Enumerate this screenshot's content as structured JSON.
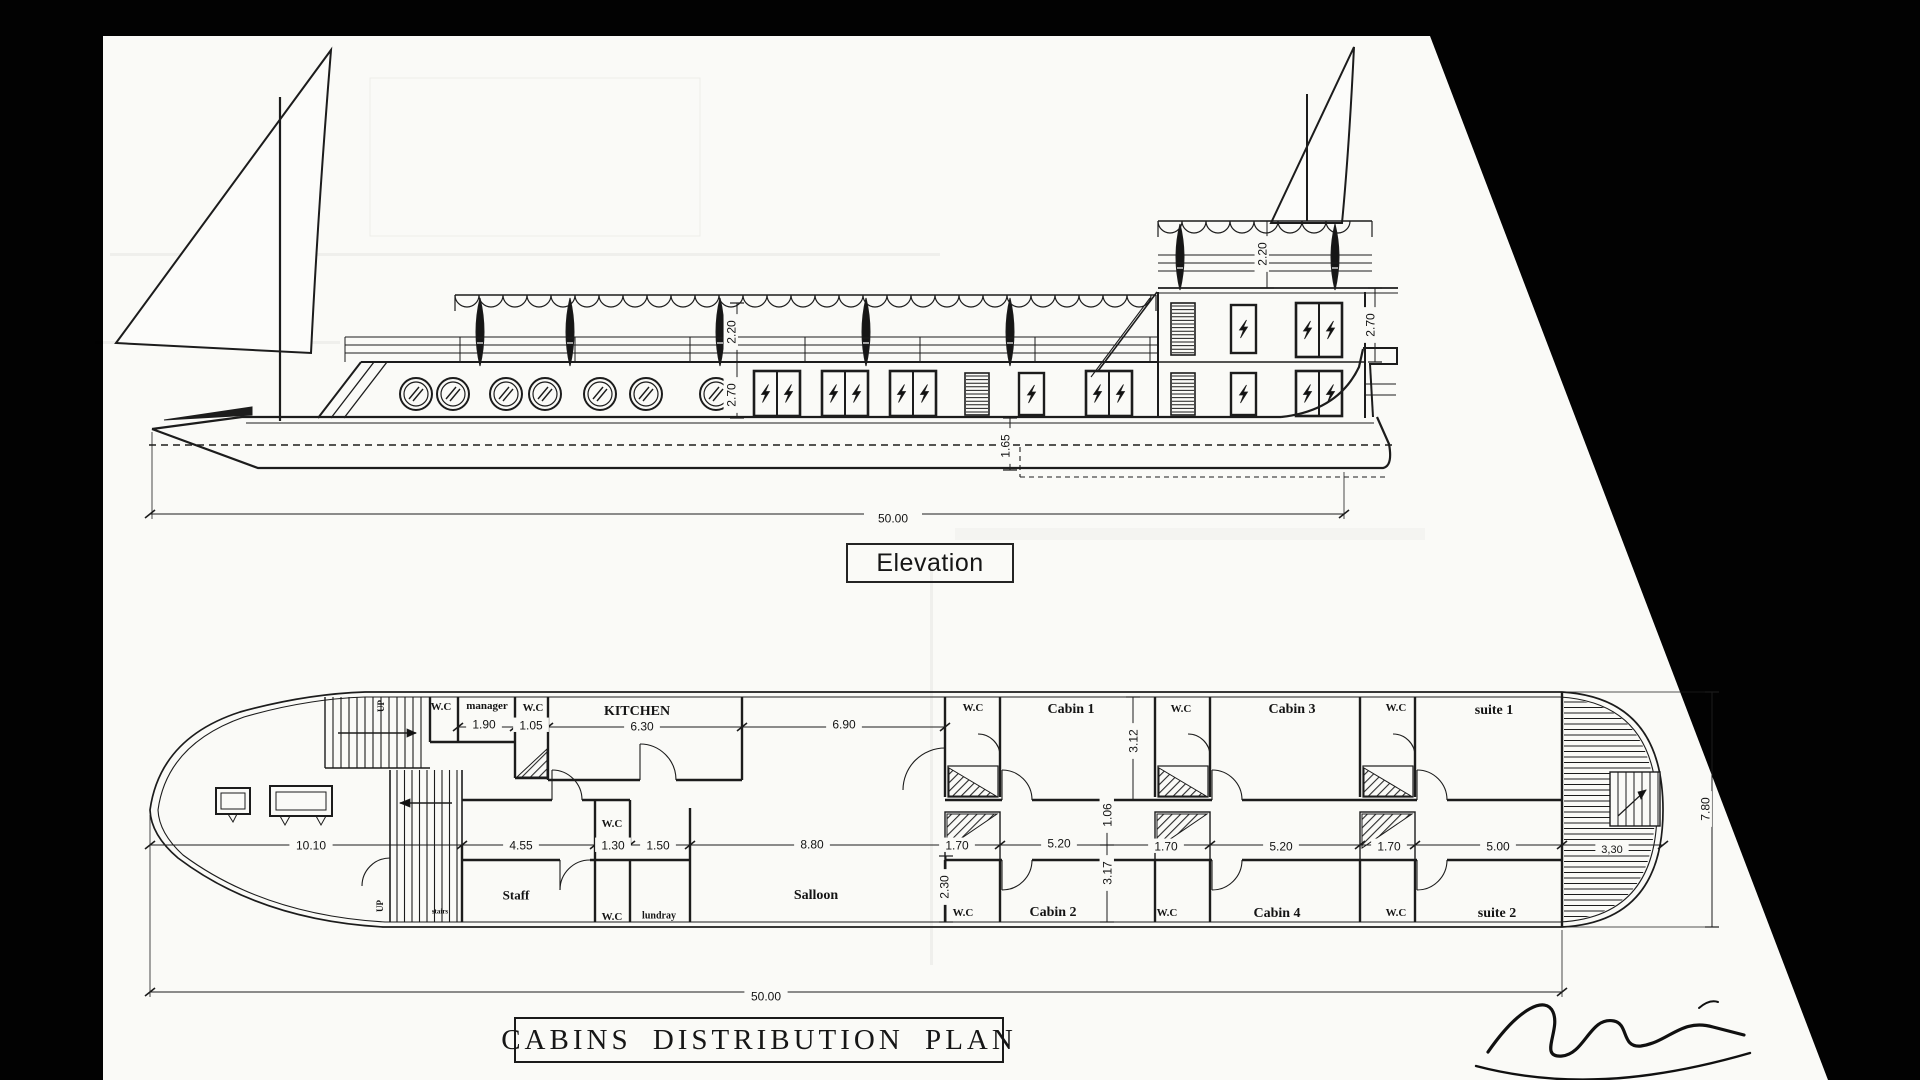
{
  "document": {
    "kind_note": "scanned naval architecture sheet",
    "colors": {
      "ink": "#1c1c1c",
      "paper": "#fafaf7",
      "surround": "#020202"
    }
  },
  "elevation": {
    "title": "Elevation",
    "dimension_labels": [
      {
        "text": "2.20",
        "x": 731,
        "y": 332,
        "rot": -90
      },
      {
        "text": "2.70",
        "x": 731,
        "y": 395,
        "rot": -90
      },
      {
        "text": "2.20",
        "x": 1262,
        "y": 254,
        "rot": -90
      },
      {
        "text": "2.70",
        "x": 1370,
        "y": 325,
        "rot": -90
      },
      {
        "text": "1.65",
        "x": 1005,
        "y": 446,
        "rot": -90
      },
      {
        "text": "50.00",
        "x": 893,
        "y": 518
      }
    ]
  },
  "plan": {
    "title": "CABINS DISTRIBUTION PLAN",
    "room_labels": [
      {
        "text": "W.C",
        "x": 441,
        "y": 706,
        "size": 11
      },
      {
        "text": "manager",
        "x": 487,
        "y": 705,
        "size": 11
      },
      {
        "text": "W.C",
        "x": 533,
        "y": 707,
        "size": 11
      },
      {
        "text": "KITCHEN",
        "x": 637,
        "y": 710,
        "size": 14
      },
      {
        "text": "W.C",
        "x": 973,
        "y": 707,
        "size": 11
      },
      {
        "text": "Cabin 1",
        "x": 1071,
        "y": 708,
        "size": 14
      },
      {
        "text": "W.C",
        "x": 1181,
        "y": 708,
        "size": 11
      },
      {
        "text": "Cabin 3",
        "x": 1292,
        "y": 708,
        "size": 14
      },
      {
        "text": "W.C",
        "x": 1396,
        "y": 707,
        "size": 11
      },
      {
        "text": "suite 1",
        "x": 1494,
        "y": 709,
        "size": 14
      },
      {
        "text": "Staff",
        "x": 516,
        "y": 895,
        "size": 13
      },
      {
        "text": "W.C",
        "x": 612,
        "y": 823,
        "size": 11
      },
      {
        "text": "W.C",
        "x": 612,
        "y": 916,
        "size": 11
      },
      {
        "text": "lundray",
        "x": 659,
        "y": 915,
        "size": 10
      },
      {
        "text": "Salloon",
        "x": 816,
        "y": 894,
        "size": 14
      },
      {
        "text": "W.C",
        "x": 963,
        "y": 912,
        "size": 11
      },
      {
        "text": "Cabin 2",
        "x": 1053,
        "y": 911,
        "size": 14
      },
      {
        "text": "W.C",
        "x": 1167,
        "y": 912,
        "size": 11
      },
      {
        "text": "Cabin 4",
        "x": 1277,
        "y": 912,
        "size": 14
      },
      {
        "text": "W.C",
        "x": 1396,
        "y": 912,
        "size": 11
      },
      {
        "text": "suite 2",
        "x": 1497,
        "y": 912,
        "size": 14
      },
      {
        "text": "UP",
        "x": 381,
        "y": 706,
        "size": 9,
        "rot": -90
      },
      {
        "text": "UP",
        "x": 380,
        "y": 906,
        "size": 9,
        "rot": -90
      },
      {
        "text": "stairs",
        "x": 440,
        "y": 911,
        "size": 7
      }
    ],
    "dimension_labels": [
      {
        "text": "1.90",
        "x": 484,
        "y": 724
      },
      {
        "text": "1.05",
        "x": 531,
        "y": 725
      },
      {
        "text": "6.30",
        "x": 642,
        "y": 726
      },
      {
        "text": "6.90",
        "x": 844,
        "y": 724
      },
      {
        "text": "3.12",
        "x": 1133,
        "y": 741,
        "rot": -90
      },
      {
        "text": "10.10",
        "x": 311,
        "y": 845
      },
      {
        "text": "4.55",
        "x": 521,
        "y": 845
      },
      {
        "text": "1.30",
        "x": 613,
        "y": 845
      },
      {
        "text": "1.50",
        "x": 658,
        "y": 845
      },
      {
        "text": "8.80",
        "x": 812,
        "y": 844
      },
      {
        "text": "1.70",
        "x": 957,
        "y": 845
      },
      {
        "text": "5.20",
        "x": 1059,
        "y": 843
      },
      {
        "text": "1.06",
        "x": 1107,
        "y": 815,
        "rot": -90
      },
      {
        "text": "3.17",
        "x": 1107,
        "y": 873,
        "rot": -90
      },
      {
        "text": "2.30",
        "x": 944,
        "y": 887,
        "rot": -90
      },
      {
        "text": "1.70",
        "x": 1166,
        "y": 846
      },
      {
        "text": "5.20",
        "x": 1281,
        "y": 846
      },
      {
        "text": "1.70",
        "x": 1389,
        "y": 846
      },
      {
        "text": "5.00",
        "x": 1498,
        "y": 846
      },
      {
        "text": "3,30",
        "x": 1612,
        "y": 849,
        "size": 11
      },
      {
        "text": "7.80",
        "x": 1705,
        "y": 809,
        "rot": -90
      },
      {
        "text": "50.00",
        "x": 766,
        "y": 996
      }
    ]
  }
}
